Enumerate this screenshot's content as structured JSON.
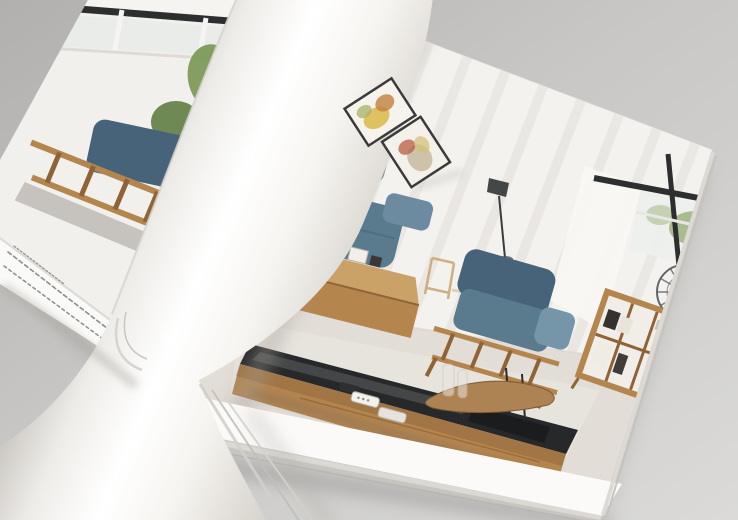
{
  "scene": {
    "type": "photograph",
    "subject": "Open furniture catalog with a glossy page mid-turn, showing a modern living-room spread",
    "setting": "catalog lying on a neutral gray surface, photographed at a steep diagonal angle",
    "objects": [
      {
        "name": "left-page",
        "desc": "partially visible page with black-framed window, bamboo plant and wood-framed blue sofa"
      },
      {
        "name": "turning-page",
        "desc": "white glossy page curled into a cylinder across the centre of the spread"
      },
      {
        "name": "right-page",
        "desc": "full-bleed living-room interior photo with white panelled walls"
      },
      {
        "name": "wall-art",
        "desc": "two small dark-framed pictures printed on the curling page"
      },
      {
        "name": "corner-sofa",
        "desc": "steel-blue fabric corner sofa with oak frame"
      },
      {
        "name": "armchair",
        "desc": "steel-blue fabric armchair with slatted oak frame"
      },
      {
        "name": "side-cabinet",
        "desc": "low oak side cabinet beside the sofa"
      },
      {
        "name": "tv-cabinet",
        "desc": "long oak TV cabinet with black glass top"
      },
      {
        "name": "driftwood-sculpture",
        "desc": "driftwood ornament on a black base"
      },
      {
        "name": "remote-controls",
        "desc": "remote controls lying on the cabinet"
      },
      {
        "name": "bookshelf",
        "desc": "oak cube bookshelf with books and a small plant"
      },
      {
        "name": "ferris-wheel-decor",
        "desc": "miniature ferris-wheel ornament in front of the right window"
      },
      {
        "name": "floor-lamp",
        "desc": "slim dark floor lamp silhouette"
      },
      {
        "name": "dining-set",
        "desc": "light-wood dining chairs faint in the background"
      },
      {
        "name": "window-right",
        "desc": "black-framed window with greenery outside"
      },
      {
        "name": "fine-print",
        "desc": "two rows of tiny illegible product-specification text on the left page margin"
      },
      {
        "name": "footer-text",
        "desc": "faint illegible footer text near the bottom page corner"
      }
    ]
  },
  "palette": {
    "background_gray": "#c6c5c3",
    "page_white": "#f7f6f4",
    "wall_white": "#f4f2ee",
    "floor_beige": "#e2ddd6",
    "sofa_blue": "#5a7a8e",
    "sofa_blue_dark": "#47637a",
    "sofa_blue_light": "#7595a8",
    "wood": "#b5854e",
    "wood_dark": "#8f6336",
    "wood_light": "#caa268",
    "glass_black": "#26282a",
    "frame_black": "#2d2e30",
    "plant_green": "#7d9a5a",
    "plant_green_dark": "#5f7d42",
    "fine_print_gray": "#8f8d89"
  }
}
